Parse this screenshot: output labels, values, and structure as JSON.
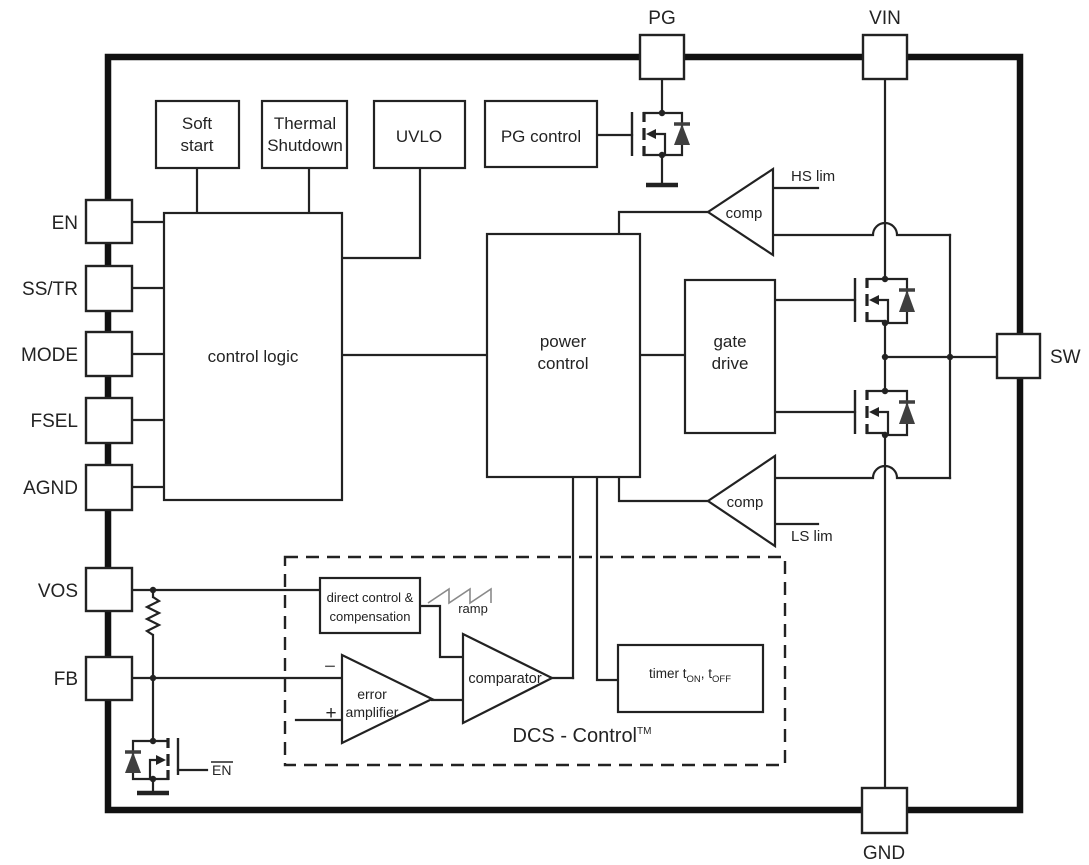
{
  "diagram": {
    "pins": {
      "pg": "PG",
      "vin": "VIN",
      "sw": "SW",
      "gnd": "GND",
      "en": "EN",
      "ss_tr": "SS/TR",
      "mode": "MODE",
      "fsel": "FSEL",
      "agnd": "AGND",
      "vos": "VOS",
      "fb": "FB"
    },
    "blocks": {
      "soft_start": {
        "line1": "Soft",
        "line2": "start"
      },
      "thermal_shutdown": {
        "line1": "Thermal",
        "line2": "Shutdown"
      },
      "uvlo": "UVLO",
      "pg_control": "PG control",
      "control_logic": "control logic",
      "power_control": {
        "line1": "power",
        "line2": "control"
      },
      "gate_drive": {
        "line1": "gate",
        "line2": "drive"
      },
      "direct_control": {
        "line1": "direct control &",
        "line2": "compensation"
      },
      "timer": {
        "prefix": "timer t",
        "sub1": "ON",
        "mid": ", t",
        "sub2": "OFF"
      }
    },
    "comparators": {
      "hs_comp": "comp",
      "hs_lim": "HS lim",
      "ls_comp": "comp",
      "ls_lim": "LS lim",
      "error_amp": {
        "line1": "error",
        "line2": "amplifier"
      },
      "main_comparator": "comparator",
      "minus": "−",
      "plus": "+"
    },
    "labels": {
      "ramp": "ramp",
      "dcs_control": "DCS - Control",
      "dcs_tm": "TM",
      "discharge_gate": "EN"
    },
    "colors": {
      "line": "#222222",
      "diode_fill": "#3f3f3f",
      "ramp_gray": "#8a8a8a",
      "background": "#ffffff"
    }
  }
}
